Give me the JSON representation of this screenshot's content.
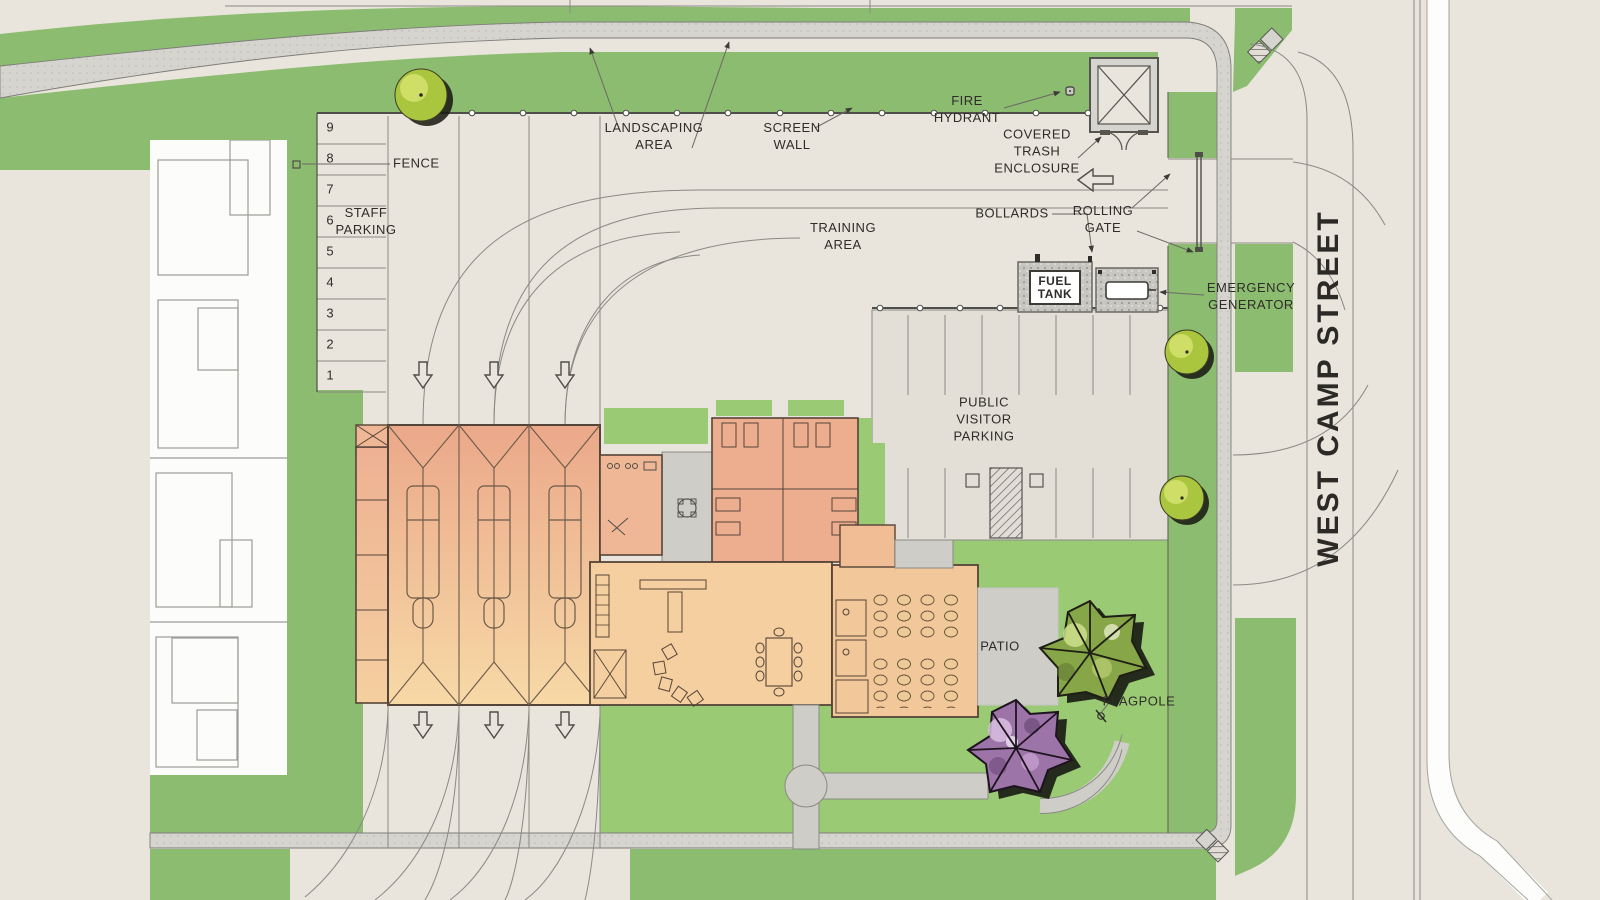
{
  "plan": {
    "street_name": "WEST CAMP STREET",
    "labels": {
      "fence": "FENCE",
      "staff_parking": "STAFF PARKING",
      "landscaping_area": "LANDSCAPING AREA",
      "screen_wall": "SCREEN WALL",
      "fire_hydrant": "FIRE HYDRANT",
      "covered_trash_enclosure": "COVERED TRASH ENCLOSURE",
      "bollards": "BOLLARDS",
      "rolling_gate": "ROLLING GATE",
      "fuel_tank": "FUEL TANK",
      "emergency_generator": "EMERGENCY GENERATOR",
      "training_area": "TRAINING AREA",
      "public_visitor_parking": "PUBLIC VISITOR PARKING",
      "patio": "PATIO",
      "flagpole": "FLAGPOLE"
    },
    "staff_parking_stalls": [
      "9",
      "8",
      "7",
      "6",
      "5",
      "4",
      "3",
      "2",
      "1"
    ],
    "icons": [
      "down-arrow-icon",
      "left-arrow-icon",
      "tree-icon",
      "fire-hydrant-icon",
      "flagpole-icon"
    ],
    "colors": {
      "grass": "#8cbc70",
      "lawn": "#9aca74",
      "pavement": "#e9e4dc",
      "sidewalk": "#d6d4cf",
      "concrete": "#cfcdc8",
      "building_front": "#eca98b",
      "building_back": "#f6d7a5",
      "tree_green": "#a9c63e",
      "tree_purple": "#9d74a8",
      "ink": "#4f4e4a"
    }
  }
}
